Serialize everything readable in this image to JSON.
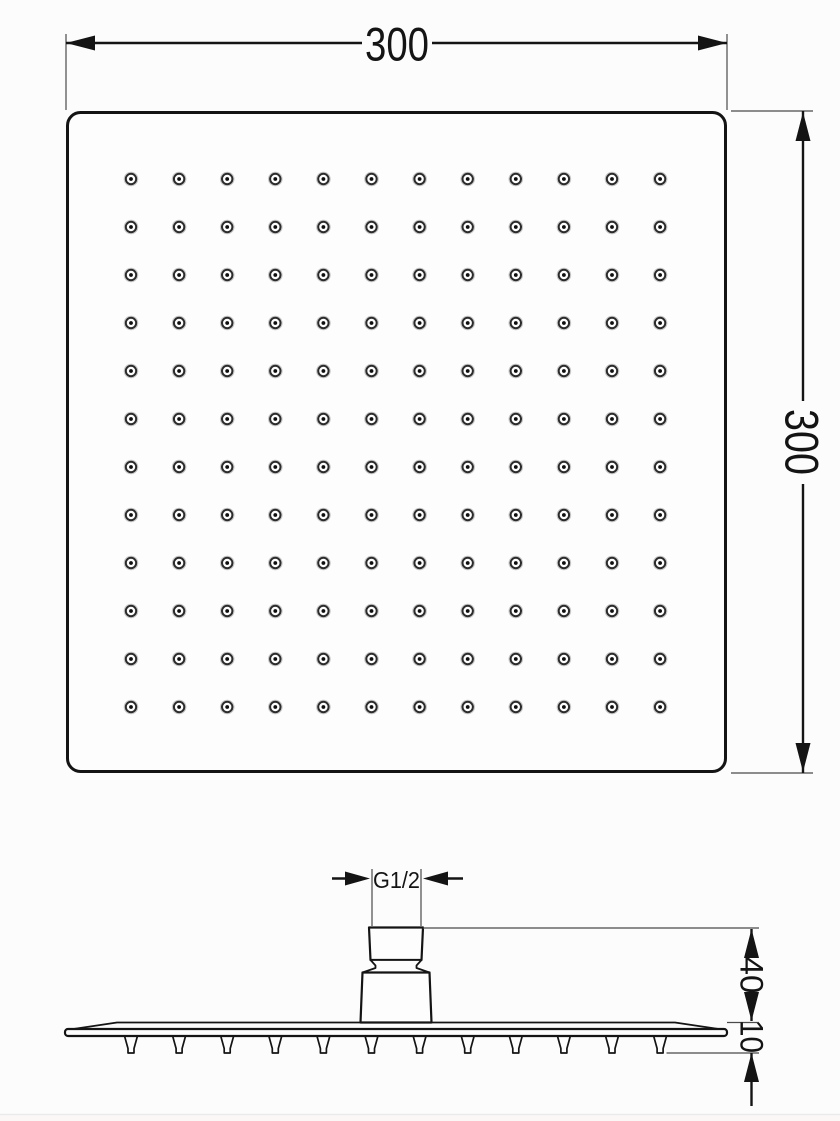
{
  "drawing": {
    "kind": "technical-dimension-drawing",
    "subject": "square rain shower head (top view and side view)",
    "labels": {
      "width": "300",
      "height": "300",
      "thread": "G1/2",
      "connector_height": "40",
      "plate_thickness": "10"
    },
    "top_view": {
      "nozzle_grid": {
        "rows": 12,
        "cols": 12
      }
    },
    "side_view": {
      "teeth_count": 12
    },
    "colors": {
      "line": "#141414",
      "thin_line": "#4a4a4a",
      "background": "#fcfcfc",
      "nozzle_ring": "#2b2b2b",
      "nozzle_center": "#0e0e0e",
      "nozzle_halo": "#c6c6c6",
      "fill": "#fdfdfd"
    }
  }
}
